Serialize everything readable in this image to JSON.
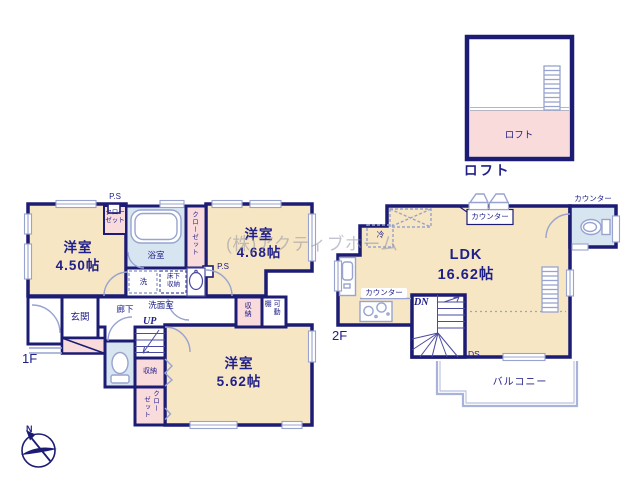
{
  "watermark": "(株)アクティブホーム",
  "compass": {
    "north_label": "N"
  },
  "loft": {
    "floor_label": "ロフト",
    "room_label": "ロフト"
  },
  "floor1": {
    "floor_label": "1F",
    "room_450_name": "洋室",
    "room_450_size": "4.50帖",
    "room_468_name": "洋室",
    "room_468_size": "4.68帖",
    "room_562_name": "洋室",
    "room_562_size": "5.62帖",
    "bath": "浴室",
    "washroom": "洗面室",
    "entrance": "玄関",
    "hallway": "廊下",
    "up": "UP",
    "ps_top": "P.S",
    "ps_mid": "P.S",
    "washer": "洗",
    "underfloor_line1": "床下",
    "underfloor_line2": "収納",
    "closet_a_line1": "クロー",
    "closet_a_line2": "ゼット",
    "closet_b": "クローゼット",
    "closet_c_col1": "クロー",
    "closet_c_col2": "ゼット",
    "storage_stairs": "収納",
    "storage_top": "収納",
    "shelf_col1": "可動",
    "shelf_col2": "棚"
  },
  "floor2": {
    "floor_label": "2F",
    "ldk_name": "LDK",
    "ldk_size": "16.62帖",
    "counter_window": "カウンター",
    "counter_toilet": "カウンター",
    "counter_kitchen": "カウンター",
    "fridge": "冷",
    "down": "DN",
    "duct": "DS",
    "balcony": "バルコニー"
  },
  "colors": {
    "wall": "#1c1c74",
    "room_cream": "#f7e6c3",
    "closet_pink": "#fadbdb",
    "wet_blue": "#d7e5f1",
    "fixture_line": "#98a3d0",
    "text_navy": "#20208a",
    "watermark_gray": "#c6c6d0"
  }
}
